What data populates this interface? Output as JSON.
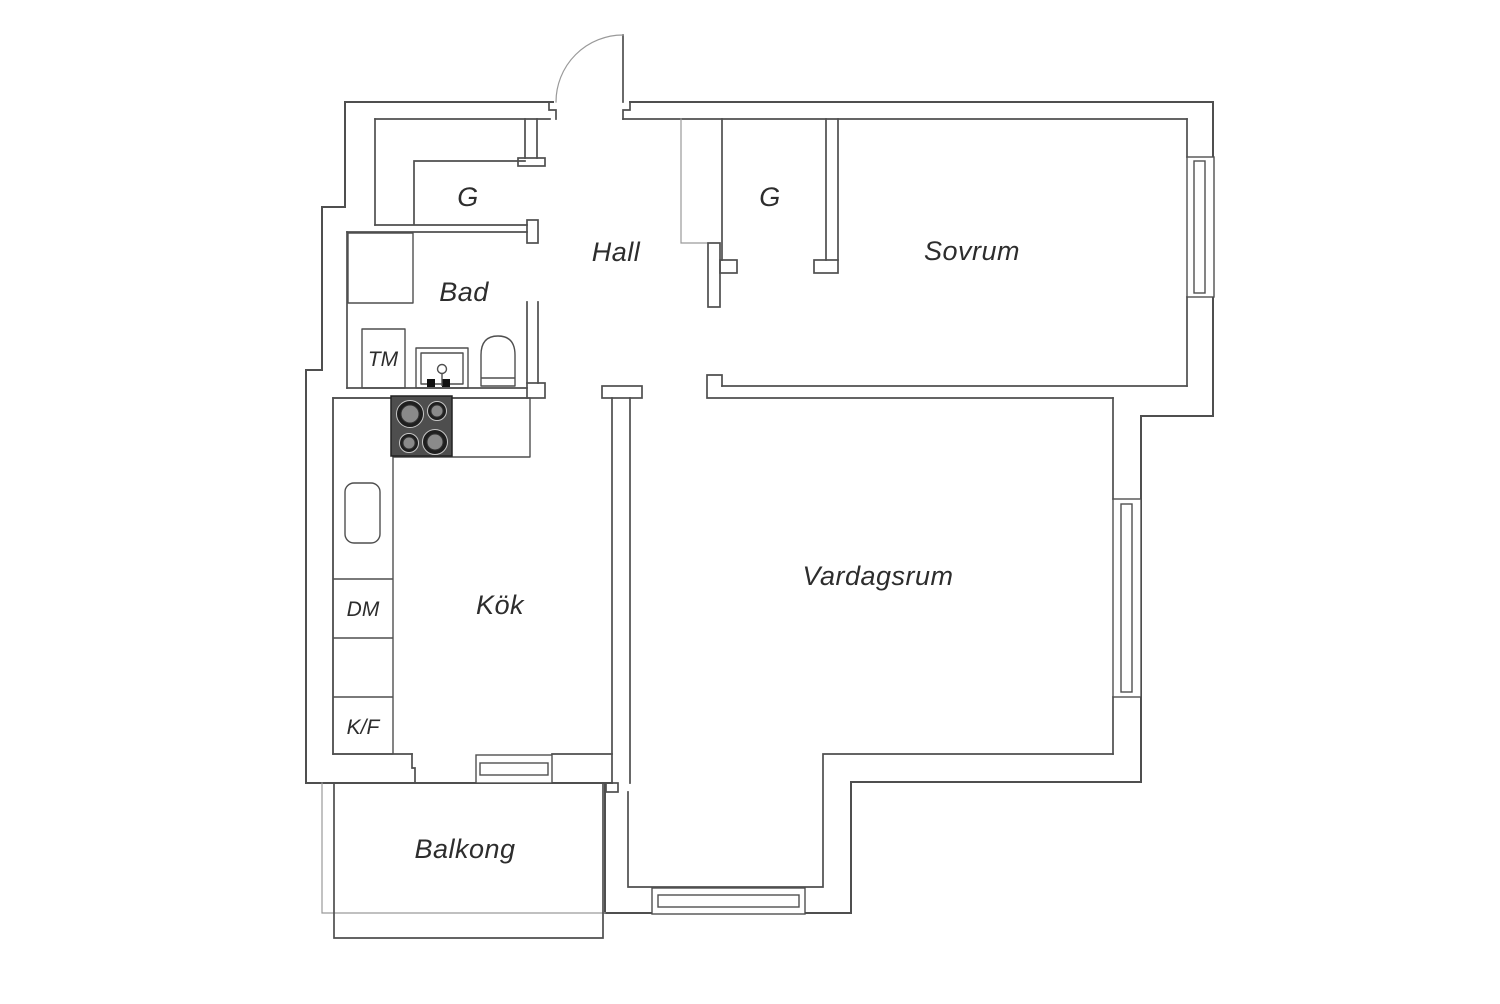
{
  "floor_plan": {
    "title": "Apartment floor plan",
    "labels": {
      "hall": "Hall",
      "bad": "Bad",
      "sovrum": "Sovrum",
      "kok": "Kök",
      "vardagsrum": "Vardagsrum",
      "balkong": "Balkong",
      "closet": "G",
      "washing_machine": "TM",
      "dishwasher": "DM",
      "fridge_freezer": "K/F"
    },
    "colors": {
      "background": "#ffffff",
      "wall_line": "#4f4f4f",
      "thin_line": "#9a9a9a",
      "stove_body": "#4e4e4e",
      "burner_ring": "#1f1f1f",
      "burner_center": "#8a8a8a",
      "label_color": "#2d2d2d",
      "tap_color": "#111111"
    }
  }
}
